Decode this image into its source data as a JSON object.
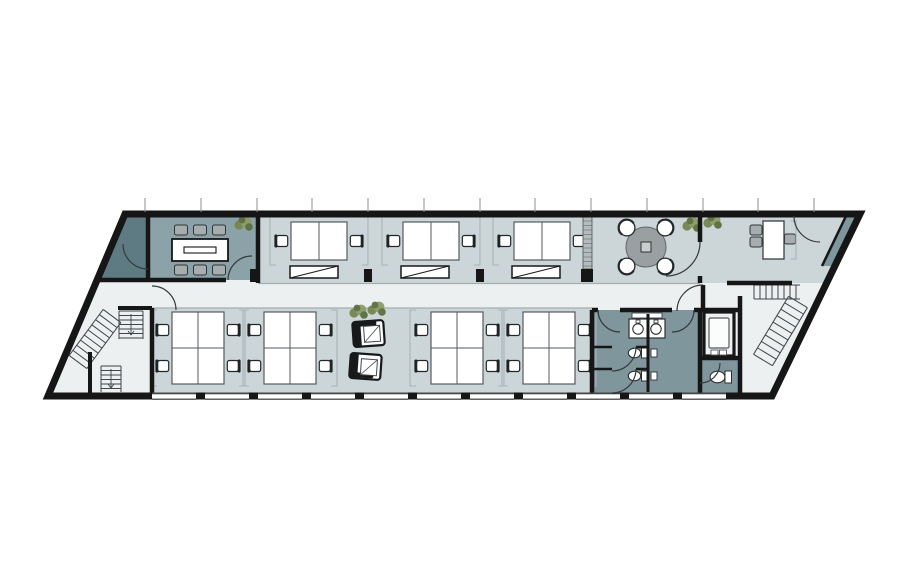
{
  "canvas": {
    "w": 911,
    "h": 583,
    "bg": "#ffffff"
  },
  "colors": {
    "bg": "#ffffff",
    "wall": "#161616",
    "floor": "#edf0f1",
    "open": "#ccd6d9",
    "meeting": "#8ba2a8",
    "ante": "#5e7b83",
    "teal": "#7f969d",
    "shelf": "#b5bcbe",
    "tableGray": "#9a9fa1",
    "chairGray": "#a7adaf",
    "bracket": "#a9b3b6",
    "boundary": "#a2aeb2",
    "plantA": "#75864f",
    "plantB": "#8d9c66",
    "plantC": "#5c6f3f",
    "tick": "#8d8d8d",
    "stair": "#3f4548",
    "door": "#34393c",
    "glass": "#2c2c2c",
    "deskStroke": "#565b60"
  },
  "outline": [
    [
      125,
      214
    ],
    [
      860,
      214
    ],
    [
      772,
      396
    ],
    [
      48,
      396
    ]
  ],
  "rooms": [
    {
      "name": "upper-open-area",
      "poly": [
        [
          258,
          216
        ],
        [
          857,
          216
        ],
        [
          826,
          283
        ],
        [
          258,
          283
        ]
      ],
      "fill": "open"
    },
    {
      "name": "meeting-room",
      "rect": [
        148,
        216,
        110,
        64
      ],
      "fill": "meeting"
    },
    {
      "name": "meeting-anteroom",
      "poly": [
        [
          125,
          216
        ],
        [
          148,
          216
        ],
        [
          148,
          280
        ],
        [
          97,
          280
        ]
      ],
      "fill": "ante"
    },
    {
      "name": "stair-strip",
      "poly": [
        [
          846,
          216
        ],
        [
          858,
          216
        ],
        [
          834,
          266
        ],
        [
          822,
          266
        ]
      ],
      "fill": "teal"
    },
    {
      "name": "lower-open-area",
      "rect": [
        152,
        308,
        440,
        88
      ],
      "fill": "open"
    },
    {
      "name": "toilet-room",
      "rect": [
        592,
        310,
        108,
        86
      ],
      "fill": "teal"
    },
    {
      "name": "accessible-wc",
      "rect": [
        700,
        358,
        40,
        38
      ],
      "fill": "teal"
    }
  ],
  "boundaries": [
    [
      258,
      283.5,
      700,
      283.5
    ],
    [
      152,
      308,
      592,
      308
    ]
  ],
  "walls": [
    [
      148,
      216,
      148,
      281,
      4.5
    ],
    [
      258,
      214,
      258,
      283,
      4.5
    ],
    [
      96,
      280,
      226,
      280,
      4.5
    ],
    [
      700,
      216,
      700,
      242,
      4.5
    ],
    [
      700,
      276,
      700,
      283,
      4.5
    ],
    [
      727,
      283,
      792,
      283,
      4.5
    ],
    [
      703,
      285,
      703,
      311,
      4.5
    ],
    [
      592,
      310,
      598,
      310,
      4.5
    ],
    [
      620,
      310,
      672,
      310,
      4.5
    ],
    [
      694,
      310,
      700,
      310,
      4.5
    ],
    [
      592,
      310,
      592,
      396,
      4.5
    ],
    [
      700,
      310,
      700,
      396,
      4.5
    ],
    [
      648,
      314,
      648,
      392,
      3
    ],
    [
      592,
      347,
      612,
      347,
      2.5
    ],
    [
      636,
      347,
      648,
      347,
      2.5
    ],
    [
      592,
      369,
      612,
      369,
      2.5
    ],
    [
      636,
      369,
      648,
      369,
      2.5
    ],
    [
      700,
      310,
      740,
      310,
      4.5
    ],
    [
      740,
      296,
      740,
      396,
      4.5
    ],
    [
      700,
      358,
      740,
      358,
      4.5
    ],
    [
      152,
      308,
      152,
      396,
      4.5
    ],
    [
      118,
      308,
      152,
      308,
      4
    ],
    [
      90,
      352,
      90,
      394,
      4
    ],
    [
      846,
      216,
      822,
      266,
      2.5
    ]
  ],
  "jambs": [
    [
      250,
      269,
      8,
      13
    ],
    [
      364,
      269,
      8,
      13
    ],
    [
      476,
      269,
      8,
      13
    ],
    [
      581,
      269,
      12,
      13
    ]
  ],
  "doors": [
    {
      "name": "anteroom-door",
      "d": "M 123 244 A 25 25 0 0 0 148 269"
    },
    {
      "name": "meeting-room-door",
      "d": "M 228 280 A 24 24 0 0 1 252 256"
    },
    {
      "name": "stairhall-door",
      "d": "M 152 286 A 24 24 0 0 1 176 310"
    },
    {
      "name": "office-top-door",
      "d": "M 794 216 A 26 26 0 0 0 820 242"
    },
    {
      "name": "office-partition-door",
      "d": "M 700 242 A 34 34 0 0 1 666 276"
    },
    {
      "name": "lobby-door",
      "d": "M 703 285 A 26 26 0 0 0 677 311"
    },
    {
      "name": "washroom-left-door",
      "d": "M 598 310 A 22 22 0 0 0 620 332"
    },
    {
      "name": "washroom-right-door",
      "d": "M 694 310 A 22 22 0 0 1 672 332"
    },
    {
      "name": "stall-door-1",
      "d": "M 636 347 A 24 24 0 0 1 612 371"
    },
    {
      "name": "stall-door-2",
      "d": "M 636 369 A 24 24 0 0 1 612 393"
    },
    {
      "name": "accessible-wc-door",
      "d": "M 700 383 A 20 20 0 0 0 720 363"
    }
  ],
  "windows": {
    "y": 392.9,
    "h": 6.9,
    "w": 44,
    "xs": [
      152,
      205,
      258,
      311,
      364,
      417,
      470,
      523,
      576,
      629,
      682
    ]
  },
  "window_ticks": {
    "y1": 198,
    "y2": 212,
    "xs": [
      145,
      201,
      257,
      312,
      368,
      424,
      480,
      535,
      591,
      647,
      703,
      758,
      814
    ]
  },
  "stairs": [
    {
      "type": "run-slant",
      "x0": 112,
      "y0": 316,
      "x1": 78,
      "y1": 362,
      "hw": 11,
      "steps": 9
    },
    {
      "type": "run-v",
      "x": 119,
      "y": 311,
      "w": 24,
      "h": 28,
      "step": 4.5,
      "arrow": true
    },
    {
      "type": "run-v",
      "x": 101,
      "y": 366,
      "w": 20,
      "h": 26,
      "step": 4.5,
      "arrow": true
    },
    {
      "type": "run-h",
      "x": 754,
      "y": 285,
      "w": 46,
      "h": 14,
      "step": 6
    },
    {
      "type": "run-slant",
      "x0": 798,
      "y0": 302,
      "x1": 763,
      "y1": 360,
      "hw": 11,
      "steps": 9
    }
  ],
  "furniture": [
    {
      "type": "conference-table",
      "x": 200,
      "y": 250
    },
    {
      "type": "plant",
      "x": 243,
      "y": 224
    },
    {
      "type": "desk-pair",
      "x": 319,
      "y": 241
    },
    {
      "type": "desk-pair",
      "x": 431,
      "y": 241
    },
    {
      "type": "desk-pair",
      "x": 542,
      "y": 241
    },
    {
      "type": "sideboard",
      "x": 314,
      "y": 272
    },
    {
      "type": "sideboard",
      "x": 425,
      "y": 272
    },
    {
      "type": "sideboard",
      "x": 536,
      "y": 272
    },
    {
      "type": "wall-shelf",
      "x": 583,
      "y": 217
    },
    {
      "type": "round-table",
      "x": 646,
      "y": 247
    },
    {
      "type": "plant",
      "x": 691,
      "y": 225
    },
    {
      "type": "plant",
      "x": 712,
      "y": 222
    },
    {
      "type": "office-desk",
      "x": 773,
      "y": 240
    },
    {
      "type": "quad-cluster",
      "x": 198,
      "y": 348
    },
    {
      "type": "quad-cluster",
      "x": 290,
      "y": 348
    },
    {
      "type": "quad-cluster",
      "x": 457,
      "y": 348
    },
    {
      "type": "quad-cluster",
      "x": 549,
      "y": 348
    },
    {
      "type": "plant",
      "x": 358,
      "y": 312
    },
    {
      "type": "plant",
      "x": 376,
      "y": 309
    },
    {
      "type": "lounge-chair",
      "x": 369,
      "y": 333,
      "rot": -4,
      "arm": "top"
    },
    {
      "type": "lounge-chair",
      "x": 366,
      "y": 366,
      "rot": 4,
      "arm": "bottom"
    },
    {
      "type": "sink-unit",
      "x": 647,
      "y": 328
    },
    {
      "type": "toilet",
      "x": 637,
      "y": 353
    },
    {
      "type": "toilet",
      "x": 637,
      "y": 376
    },
    {
      "type": "wall-fixture",
      "x": 651,
      "y": 349
    },
    {
      "type": "wall-fixture",
      "x": 651,
      "y": 372
    },
    {
      "type": "toilet",
      "x": 720,
      "y": 377,
      "big": 1
    },
    {
      "type": "elevator",
      "x": 704,
      "y": 312
    }
  ]
}
